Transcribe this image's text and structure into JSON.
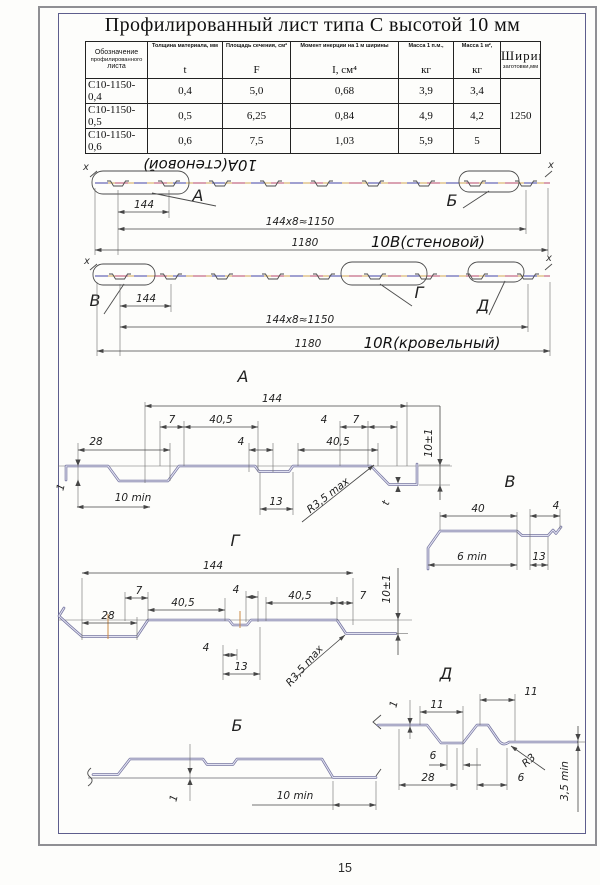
{
  "page_number": "15",
  "title": "Профилированный лист типа С высотой 10 мм",
  "table": {
    "headers": {
      "c1": [
        "Обозначение",
        "профилированного",
        "листа"
      ],
      "c2_label": "Толщина материала, мм",
      "c2_sym": "t",
      "c3_label": "Площадь сечения, см²",
      "c3_sym": "F",
      "c4_label": "Момент инерции на 1 м ширины",
      "c4_sym": "I, см⁴",
      "c5_label": "Масса 1 п.м.,",
      "c5_unit": "кг",
      "c6_label": "Масса 1 м²,",
      "c6_unit": "кг",
      "c7_line1": "Ширина",
      "c7_line2": "заготовки,мм"
    },
    "rows": [
      [
        "С10-1150-0,4",
        "0,4",
        "5,0",
        "0,68",
        "3,9",
        "3,4"
      ],
      [
        "С10-1150-0,5",
        "0,5",
        "6,25",
        "0,84",
        "4,9",
        "4,2"
      ],
      [
        "С10-1150-0,6",
        "0,6",
        "7,5",
        "1,03",
        "5,9",
        "5"
      ]
    ],
    "blank_width": "1250"
  },
  "wall_drawing": {
    "flipped_label": "10А(стеновой)",
    "type_label": "10В(стеновой)",
    "axis_left": "x",
    "axis_right": "x",
    "callout_a": "А",
    "callout_b": "Б",
    "dim_module": "144",
    "dim_modules_total": "144x8≈1150",
    "dim_width": "1180"
  },
  "roof_drawing": {
    "type_label": "10R(кровельный)",
    "axis_left": "x",
    "axis_right": "x",
    "callout_v": "В",
    "callout_g": "Г",
    "callout_d": "Д",
    "dim_module": "144",
    "dim_modules_total": "144x8≈1150",
    "dim_width": "1180"
  },
  "detail_a": {
    "title": "А",
    "dim_144": "144",
    "dim_7_left": "7",
    "dim_40_5_left": "40,5",
    "dim_4_top": "4",
    "dim_7_right": "7",
    "dim_28": "28",
    "dim_4_mid": "4",
    "dim_40_5_right": "40,5",
    "dim_13": "13",
    "dim_1": "1",
    "dim_10_min": "10 min",
    "radius": "R3,5 max",
    "thickness": "t",
    "dim_height": "10±1"
  },
  "detail_v": {
    "title": "В",
    "dim_40": "40",
    "dim_4": "4",
    "dim_6_min": "6 min",
    "dim_13": "13"
  },
  "detail_g": {
    "title": "Г",
    "dim_144": "144",
    "dim_7_left": "7",
    "dim_40_5_left": "40,5",
    "dim_4_top": "4",
    "dim_40_5_right": "40,5",
    "dim_7_right": "7",
    "dim_28": "28",
    "dim_4_mid": "4",
    "dim_13": "13",
    "radius": "R3,5 max",
    "dim_height": "10±1"
  },
  "detail_b": {
    "title": "Б",
    "dim_1": "1",
    "dim_10_min": "10 min"
  },
  "detail_d": {
    "title": "Д",
    "dim_1": "1",
    "dim_11_left": "11",
    "dim_11_right": "11",
    "dim_6_left": "6",
    "dim_28": "28",
    "dim_6_right": "6",
    "radius": "R3",
    "dim_3_5_min": "3,5 min"
  }
}
